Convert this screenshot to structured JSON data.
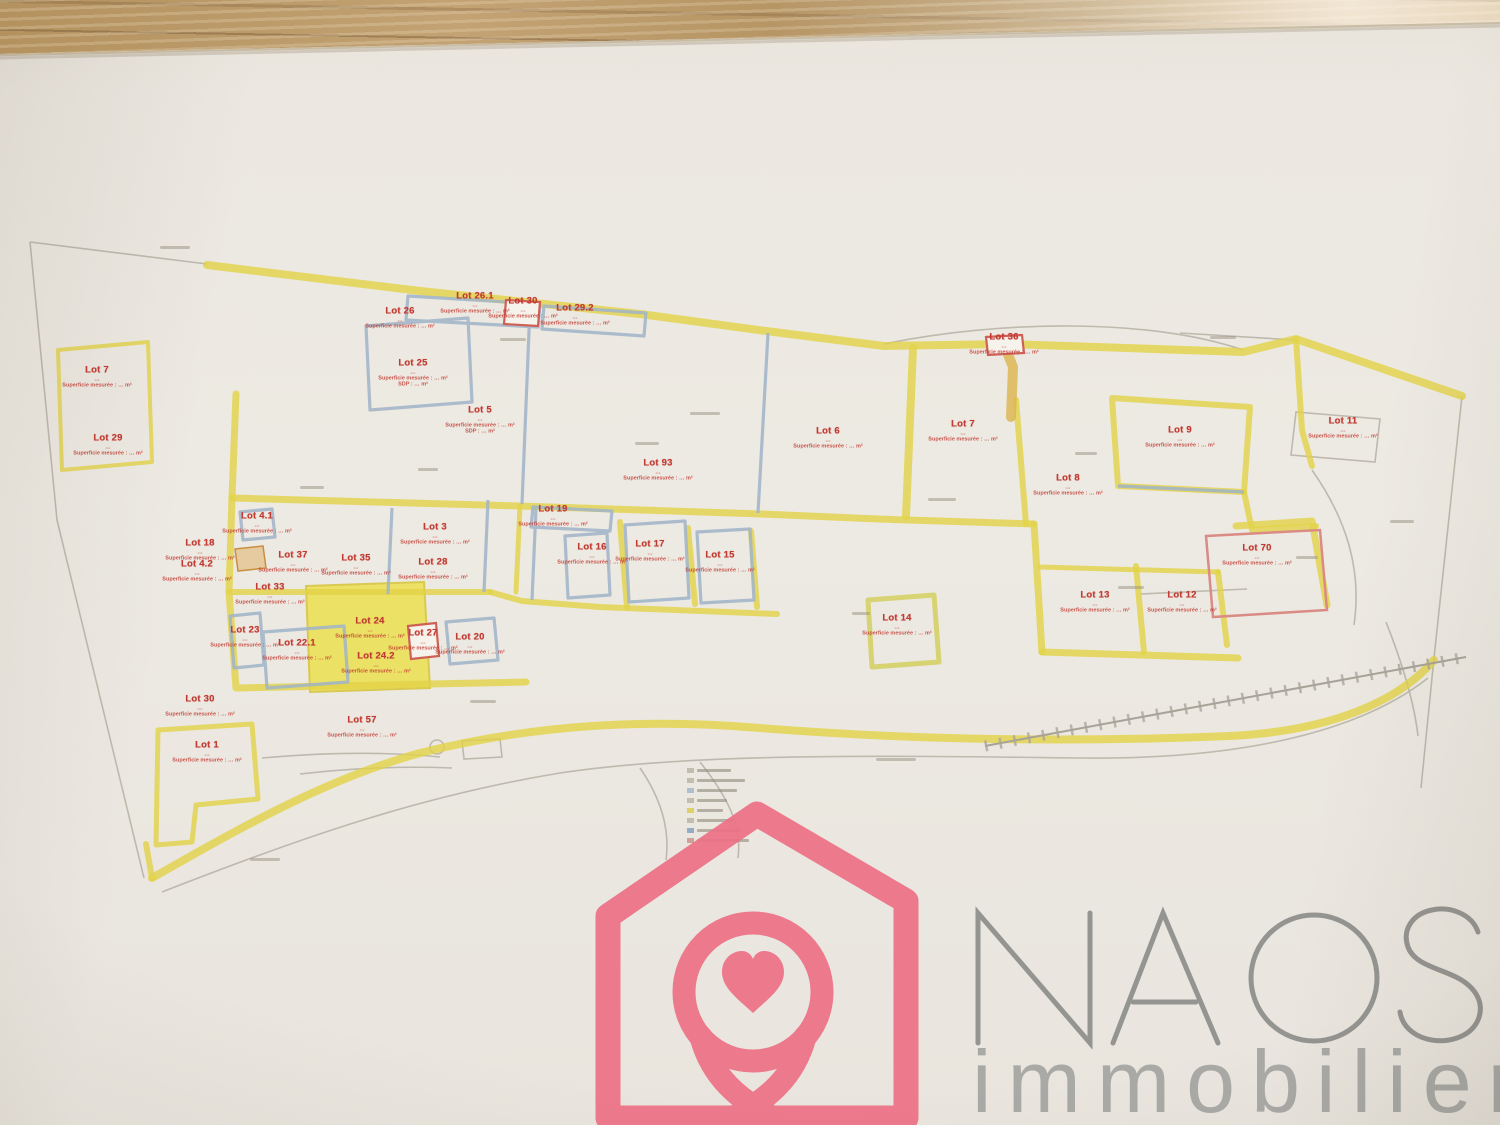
{
  "watermark": {
    "brand": "NAOS",
    "subtitle": "immobilier"
  },
  "colors": {
    "brand_pink": "#ee7186",
    "brand_gray": "#8e8e8c",
    "brand_gray_light": "#a5a5a2",
    "highlighter_yellow": "#e2d247",
    "slate_outline": "#9fb3c8",
    "lot_label_red": "#c23b32",
    "red_outline": "#cf6055",
    "wood_table": "#b99a6e",
    "paper": "#ebe7e0"
  },
  "plan": {
    "sub_default": [
      "…",
      "Superficie mesurée : … m²"
    ],
    "lots": [
      {
        "label": "Lot 7",
        "x": 97,
        "y": 377
      },
      {
        "label": "Lot 29",
        "x": 108,
        "y": 445
      },
      {
        "label": "Lot 26",
        "x": 400,
        "y": 318
      },
      {
        "label": "Lot 25",
        "x": 413,
        "y": 373,
        "sub": [
          "…",
          "Superficie mesurée : … m²",
          "SDP : … m²"
        ]
      },
      {
        "label": "Lot 26.1",
        "x": 475,
        "y": 303
      },
      {
        "label": "Lot 30",
        "x": 523,
        "y": 308
      },
      {
        "label": "Lot 29.2",
        "x": 575,
        "y": 315
      },
      {
        "label": "Lot 5",
        "x": 480,
        "y": 420,
        "sub": [
          "…",
          "Superficie mesurée : … m²",
          "SDP : … m²"
        ]
      },
      {
        "label": "Lot 93",
        "x": 658,
        "y": 470
      },
      {
        "label": "Lot 6",
        "x": 828,
        "y": 438
      },
      {
        "label": "Lot 7",
        "x": 963,
        "y": 431
      },
      {
        "label": "Lot 36",
        "x": 1004,
        "y": 344
      },
      {
        "label": "Lot 9",
        "x": 1180,
        "y": 437
      },
      {
        "label": "Lot 8",
        "x": 1068,
        "y": 485
      },
      {
        "label": "Lot 11",
        "x": 1343,
        "y": 428
      },
      {
        "label": "Lot 4.1",
        "x": 257,
        "y": 523
      },
      {
        "label": "Lot 18",
        "x": 200,
        "y": 550
      },
      {
        "label": "Lot 4.2",
        "x": 197,
        "y": 571
      },
      {
        "label": "Lot 37",
        "x": 293,
        "y": 562
      },
      {
        "label": "Lot 35",
        "x": 356,
        "y": 565
      },
      {
        "label": "Lot 33",
        "x": 270,
        "y": 594
      },
      {
        "label": "Lot 23",
        "x": 245,
        "y": 637
      },
      {
        "label": "Lot 22.1",
        "x": 297,
        "y": 650
      },
      {
        "label": "Lot 24",
        "x": 370,
        "y": 628
      },
      {
        "label": "Lot 24.2",
        "x": 376,
        "y": 663
      },
      {
        "label": "Lot 27",
        "x": 423,
        "y": 640
      },
      {
        "label": "Lot 20",
        "x": 470,
        "y": 644
      },
      {
        "label": "Lot 3",
        "x": 435,
        "y": 534
      },
      {
        "label": "Lot 28",
        "x": 433,
        "y": 569
      },
      {
        "label": "Lot 19",
        "x": 553,
        "y": 516
      },
      {
        "label": "Lot 16",
        "x": 592,
        "y": 554
      },
      {
        "label": "Lot 17",
        "x": 650,
        "y": 551
      },
      {
        "label": "Lot 15",
        "x": 720,
        "y": 562
      },
      {
        "label": "Lot 14",
        "x": 897,
        "y": 625
      },
      {
        "label": "Lot 13",
        "x": 1095,
        "y": 602
      },
      {
        "label": "Lot 12",
        "x": 1182,
        "y": 602
      },
      {
        "label": "Lot 70",
        "x": 1257,
        "y": 555
      },
      {
        "label": "Lot 30",
        "x": 200,
        "y": 706
      },
      {
        "label": "Lot 1",
        "x": 207,
        "y": 752
      },
      {
        "label": "Lot 57",
        "x": 362,
        "y": 727
      }
    ]
  }
}
